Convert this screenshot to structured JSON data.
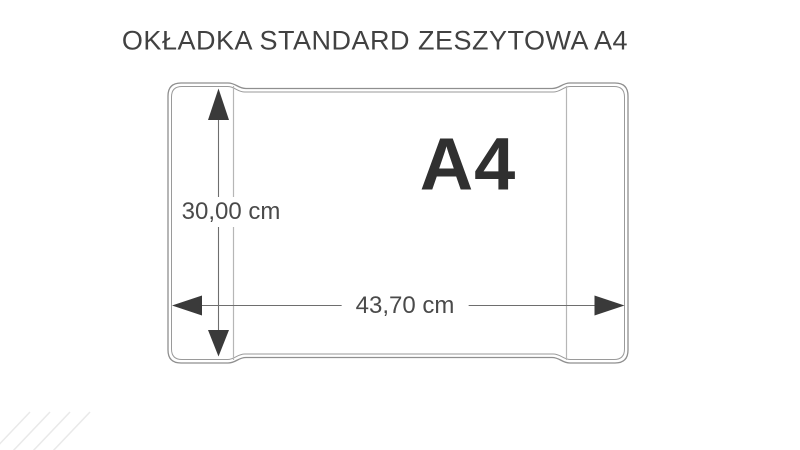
{
  "title": {
    "text": "OKŁADKA STANDARD ZESZYTOWA A4"
  },
  "diagram": {
    "format_label": "A4",
    "height_dimension": {
      "value": "30,00 cm"
    },
    "width_dimension": {
      "value": "43,70 cm"
    },
    "colors": {
      "outline": "#8f8f8f",
      "fold_line": "#b6b6b6",
      "dimension_line": "#6e6e6e",
      "arrowhead": "#3a3a3a",
      "label_text": "#4a4a4a",
      "format_text": "#303030",
      "title_text": "#414141",
      "corner_stripe": "#e9e9e9"
    }
  }
}
